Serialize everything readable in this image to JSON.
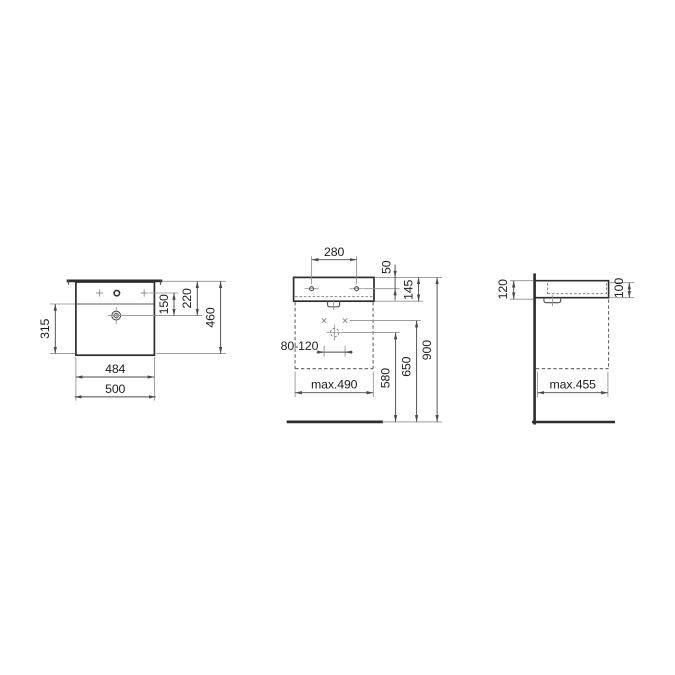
{
  "colors": {
    "bg": "#ffffff",
    "ink": "#2d2d2d",
    "line": "#4a4a4a",
    "ref": "#8f8f8f",
    "mid": "#5f5f5f",
    "txt": "#1c1c1c"
  },
  "views": {
    "top": {
      "name": "top-view",
      "dims": {
        "bowl_depth": "315",
        "tap_to_drain": "150",
        "back_to_drain": "220",
        "overall_depth": "460",
        "body_width": "484",
        "overall_width": "500"
      }
    },
    "front": {
      "name": "front-view",
      "dims": {
        "fixing_hole_spacing": "280",
        "top_to_fixing_holes": "50",
        "body_height": "145",
        "supply_spacing": "80-120",
        "cabinet_width": "max.490",
        "drain_height": "580",
        "supply_height": "650",
        "rim_height": "900"
      }
    },
    "side": {
      "name": "side-view",
      "dims": {
        "height_at_wall": "120",
        "height_at_front": "100",
        "cabinet_depth": "max.455"
      }
    }
  }
}
